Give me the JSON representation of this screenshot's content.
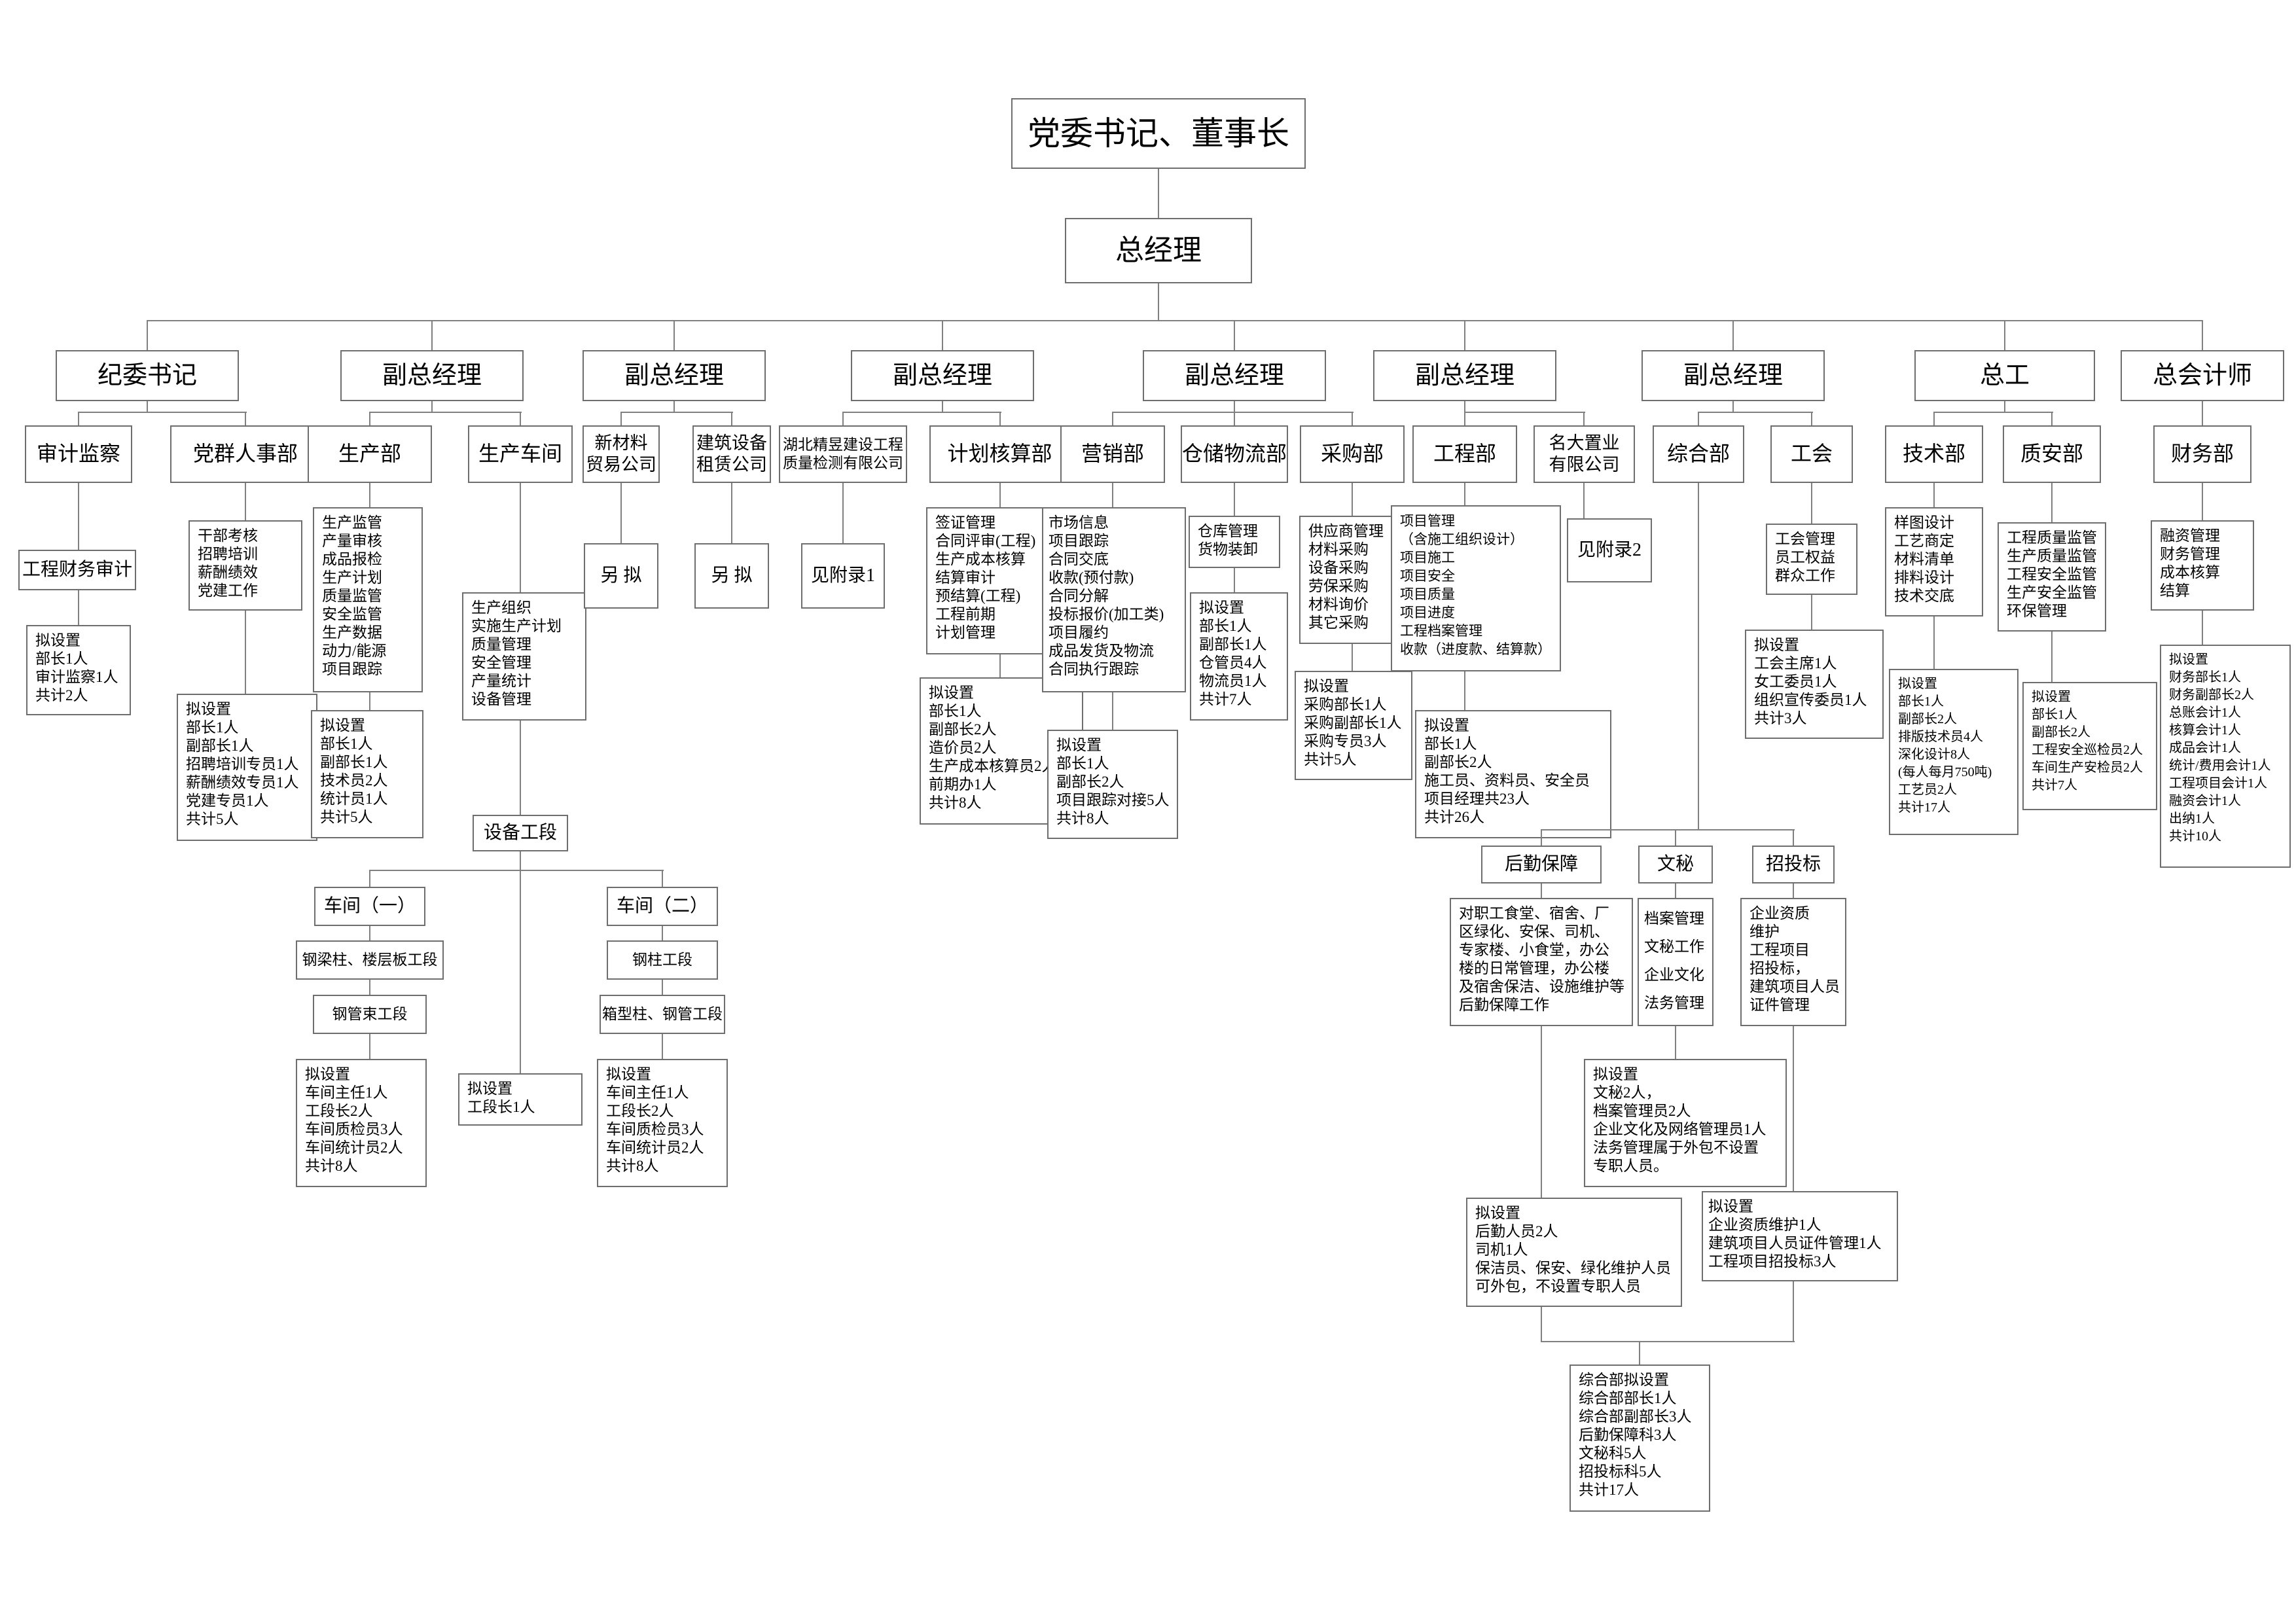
{
  "org": {
    "nodes": {
      "chairman": "党委书记、董事长",
      "general_manager": "总经理",
      "discipline_secretary": "纪委书记",
      "deputy_gm": "副总经理",
      "chief_engineer": "总工",
      "chief_accountant": "总会计师",
      "audit_supervision": "审计监察",
      "party_mass_hr": "党群人事部",
      "production_dept": "生产部",
      "production_workshop": "生产车间",
      "new_material_trading": [
        "新材料",
        "贸易公司"
      ],
      "equipment_leasing": [
        "建筑设备",
        "租赁公司"
      ],
      "hubei_jingyu": [
        "湖北精昱建设工程",
        "质量检测有限公司"
      ],
      "planning_accounting": "计划核算部",
      "marketing": "营销部",
      "warehouse_logistics": "仓储物流部",
      "purchasing": "采购部",
      "engineering": "工程部",
      "mingda_realty": [
        "名大置业",
        "有限公司"
      ],
      "general_affairs": "综合部",
      "labor_union": "工会",
      "technology": "技术部",
      "quality_safety": "质安部",
      "finance": "财务部",
      "to_be_drafted": "另  拟",
      "see_appendix_1": "见附录1",
      "see_appendix_2": "见附录2",
      "project_finance_audit": "工程财务审计",
      "equipment_section": "设备工段",
      "workshop_1": "车间（一）",
      "workshop_2": "车间（二）",
      "beam_column_slab_section": "钢梁柱、楼层板工段",
      "pipe_bundle_section": "钢管束工段",
      "steel_column_section": "钢柱工段",
      "box_column_pipe_section": "箱型柱、钢管工段",
      "logistics_support": "后勤保障",
      "secretarial": "文秘",
      "bidding": "招投标"
    },
    "details": {
      "audit_staffing": [
        "拟设置",
        "部长1人",
        "审计监察1人",
        "共计2人"
      ],
      "party_hr_duties": [
        "干部考核",
        "招聘培训",
        "薪酬绩效",
        "党建工作"
      ],
      "party_hr_staffing": [
        "拟设置",
        "部长1人",
        "副部长1人",
        "招聘培训专员1人",
        "薪酬绩效专员1人",
        "党建专员1人",
        "共计5人"
      ],
      "production_dept_duties": [
        "生产监管",
        "产量审核",
        "成品报检",
        "生产计划",
        "质量监管",
        "安全监管",
        "生产数据",
        "动力/能源",
        "项目跟踪"
      ],
      "production_dept_staffing": [
        "拟设置",
        "部长1人",
        "副部长1人",
        "技术员2人",
        "统计员1人",
        "共计5人"
      ],
      "production_workshop_duties": [
        "生产组织",
        "实施生产计划",
        "质量管理",
        "安全管理",
        "产量统计",
        "设备管理"
      ],
      "equipment_section_staffing": [
        "拟设置",
        "工段长1人"
      ],
      "workshop_staffing": [
        "拟设置",
        "车间主任1人",
        "工段长2人",
        "车间质检员3人",
        "车间统计员2人",
        "共计8人"
      ],
      "planning_accounting_duties": [
        "签证管理",
        "合同评审(工程)",
        "生产成本核算",
        "结算审计",
        "预结算(工程)",
        "工程前期",
        "计划管理"
      ],
      "planning_accounting_staffing": [
        "拟设置",
        "部长1人",
        "副部长2人",
        "造价员2人",
        "生产成本核算员2人",
        "前期办1人",
        "共计8人"
      ],
      "marketing_duties": [
        "市场信息",
        "项目跟踪",
        "合同交底",
        "收款(预付款)",
        "合同分解",
        "投标报价(加工类)",
        "项目履约",
        "成品发货及物流",
        "合同执行跟踪"
      ],
      "marketing_staffing": [
        "拟设置",
        "部长1人",
        "副部长2人",
        "项目跟踪对接5人",
        "共计8人"
      ],
      "warehouse_logistics_duties": [
        "仓库管理",
        "货物装卸"
      ],
      "warehouse_logistics_staffing": [
        "拟设置",
        "部长1人",
        "副部长1人",
        "仓管员4人",
        "物流员1人",
        "共计7人"
      ],
      "purchasing_duties": [
        "供应商管理",
        "材料采购",
        "设备采购",
        "劳保采购",
        "材料询价",
        "其它采购"
      ],
      "purchasing_staffing": [
        "拟设置",
        "采购部长1人",
        "采购副部长1人",
        "采购专员3人",
        "共计5人"
      ],
      "engineering_duties": [
        "项目管理",
        "（含施工组织设计）",
        "项目施工",
        "项目安全",
        "项目质量",
        "项目进度",
        "工程档案管理",
        "收款（进度款、结算款）"
      ],
      "engineering_staffing": [
        "拟设置",
        "部长1人",
        "副部长2人",
        "施工员、资料员、安全员",
        "项目经理共23人",
        "共计26人"
      ],
      "logistics_support_duties": [
        "对职工食堂、宿舍、厂",
        "区绿化、安保、司机、",
        "专家楼、小食堂，办公",
        "楼的日常管理，办公楼",
        "及宿舍保洁、设施维护等",
        "后勤保障工作"
      ],
      "logistics_support_staffing": [
        "拟设置",
        "后勤人员2人",
        "司机1人",
        "保洁员、保安、绿化维护人员",
        "可外包，不设置专职人员"
      ],
      "secretarial_duties": [
        "档案管理",
        "文秘工作",
        "企业文化",
        "法务管理"
      ],
      "secretarial_staffing": [
        "拟设置",
        "文秘2人，",
        "档案管理员2人",
        "企业文化及网络管理员1人",
        "法务管理属于外包不设置",
        "专职人员。"
      ],
      "bidding_duties": [
        "企业资质",
        "维护",
        "工程项目",
        "招投标，",
        "建筑项目人员",
        "证件管理"
      ],
      "bidding_staffing": [
        "拟设置",
        "企业资质维护1人",
        "建筑项目人员证件管理1人",
        "工程项目招投标3人"
      ],
      "general_affairs_summary": [
        "综合部拟设置",
        "综合部部长1人",
        "综合部副部长3人",
        "后勤保障科3人",
        "文秘科5人",
        "招投标科5人",
        "共计17人"
      ],
      "labor_union_duties": [
        "工会管理",
        "员工权益",
        "群众工作"
      ],
      "labor_union_staffing": [
        "拟设置",
        "工会主席1人",
        "女工委员1人",
        "组织宣传委员1人",
        "共计3人"
      ],
      "technology_duties": [
        "样图设计",
        "工艺商定",
        "材料清单",
        "排料设计",
        "技术交底"
      ],
      "technology_staffing": [
        "拟设置",
        "部长1人",
        "副部长2人",
        "排版技术员4人",
        "深化设计8人",
        "(每人每月750吨)",
        "工艺员2人",
        "共计17人"
      ],
      "quality_safety_duties": [
        "工程质量监管",
        "生产质量监管",
        "工程安全监管",
        "生产安全监管",
        "环保管理"
      ],
      "quality_safety_staffing": [
        "拟设置",
        "部长1人",
        "副部长2人",
        "工程安全巡检员2人",
        "车间生产安检员2人",
        "共计7人"
      ],
      "finance_duties": [
        "融资管理",
        "财务管理",
        "成本核算",
        "结算"
      ],
      "finance_staffing": [
        "拟设置",
        "财务部长1人",
        "财务副部长2人",
        "总账会计1人",
        "核算会计1人",
        "成品会计1人",
        "统计/费用会计1人",
        "工程项目会计1人",
        "融资会计1人",
        "出纳1人",
        "共计10人"
      ]
    }
  }
}
